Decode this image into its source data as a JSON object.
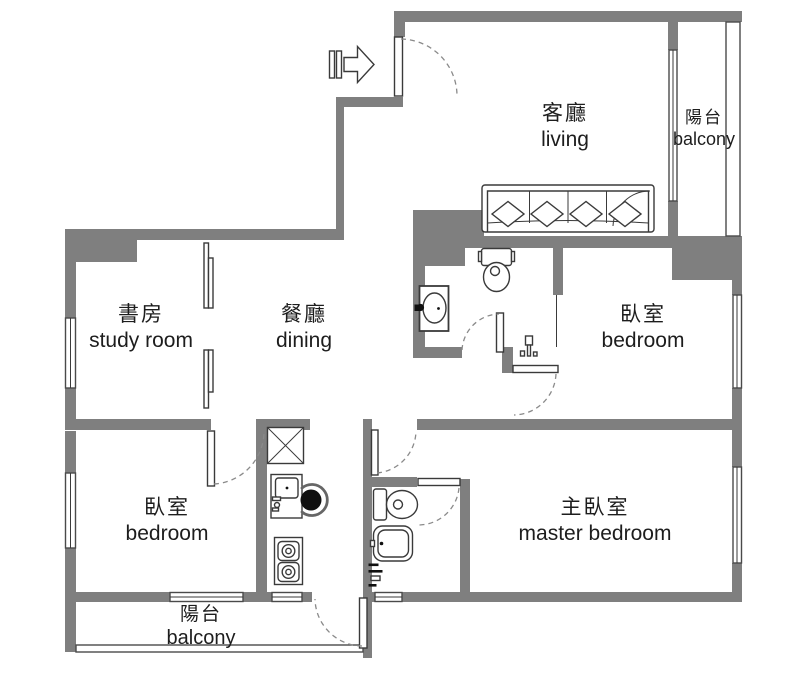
{
  "title": "apartment floor plan",
  "colors": {
    "wall": "#7f7f7f",
    "outline": "#3a3a3a",
    "dash": "#8a8a8a",
    "text": "#1d1d1d",
    "background": "#ffffff"
  },
  "rooms": {
    "living": {
      "zh": "客廳",
      "en": "living"
    },
    "balcony_top": {
      "zh": "陽台",
      "en": "balcony"
    },
    "study": {
      "zh": "書房",
      "en": "study room"
    },
    "dining": {
      "zh": "餐廳",
      "en": "dining"
    },
    "bedroom_right": {
      "zh": "臥室",
      "en": "bedroom"
    },
    "bedroom_left": {
      "zh": "臥室",
      "en": "bedroom"
    },
    "master_bedroom": {
      "zh": "主臥室",
      "en": "master bedroom"
    },
    "balcony_bottom": {
      "zh": "陽台",
      "en": "balcony"
    }
  },
  "fixtures": [
    "entry-arrow",
    "entry-door",
    "sofa",
    "toilet",
    "vanity-sink",
    "shower-mixer",
    "sliding-partition",
    "refrigerator",
    "kitchen-sink",
    "kitchen-chair",
    "gas-stove",
    "master-toilet",
    "master-sink",
    "master-shower-mixer",
    "shower-screen",
    "door-swing-arcs",
    "windows",
    "balcony-railing"
  ]
}
